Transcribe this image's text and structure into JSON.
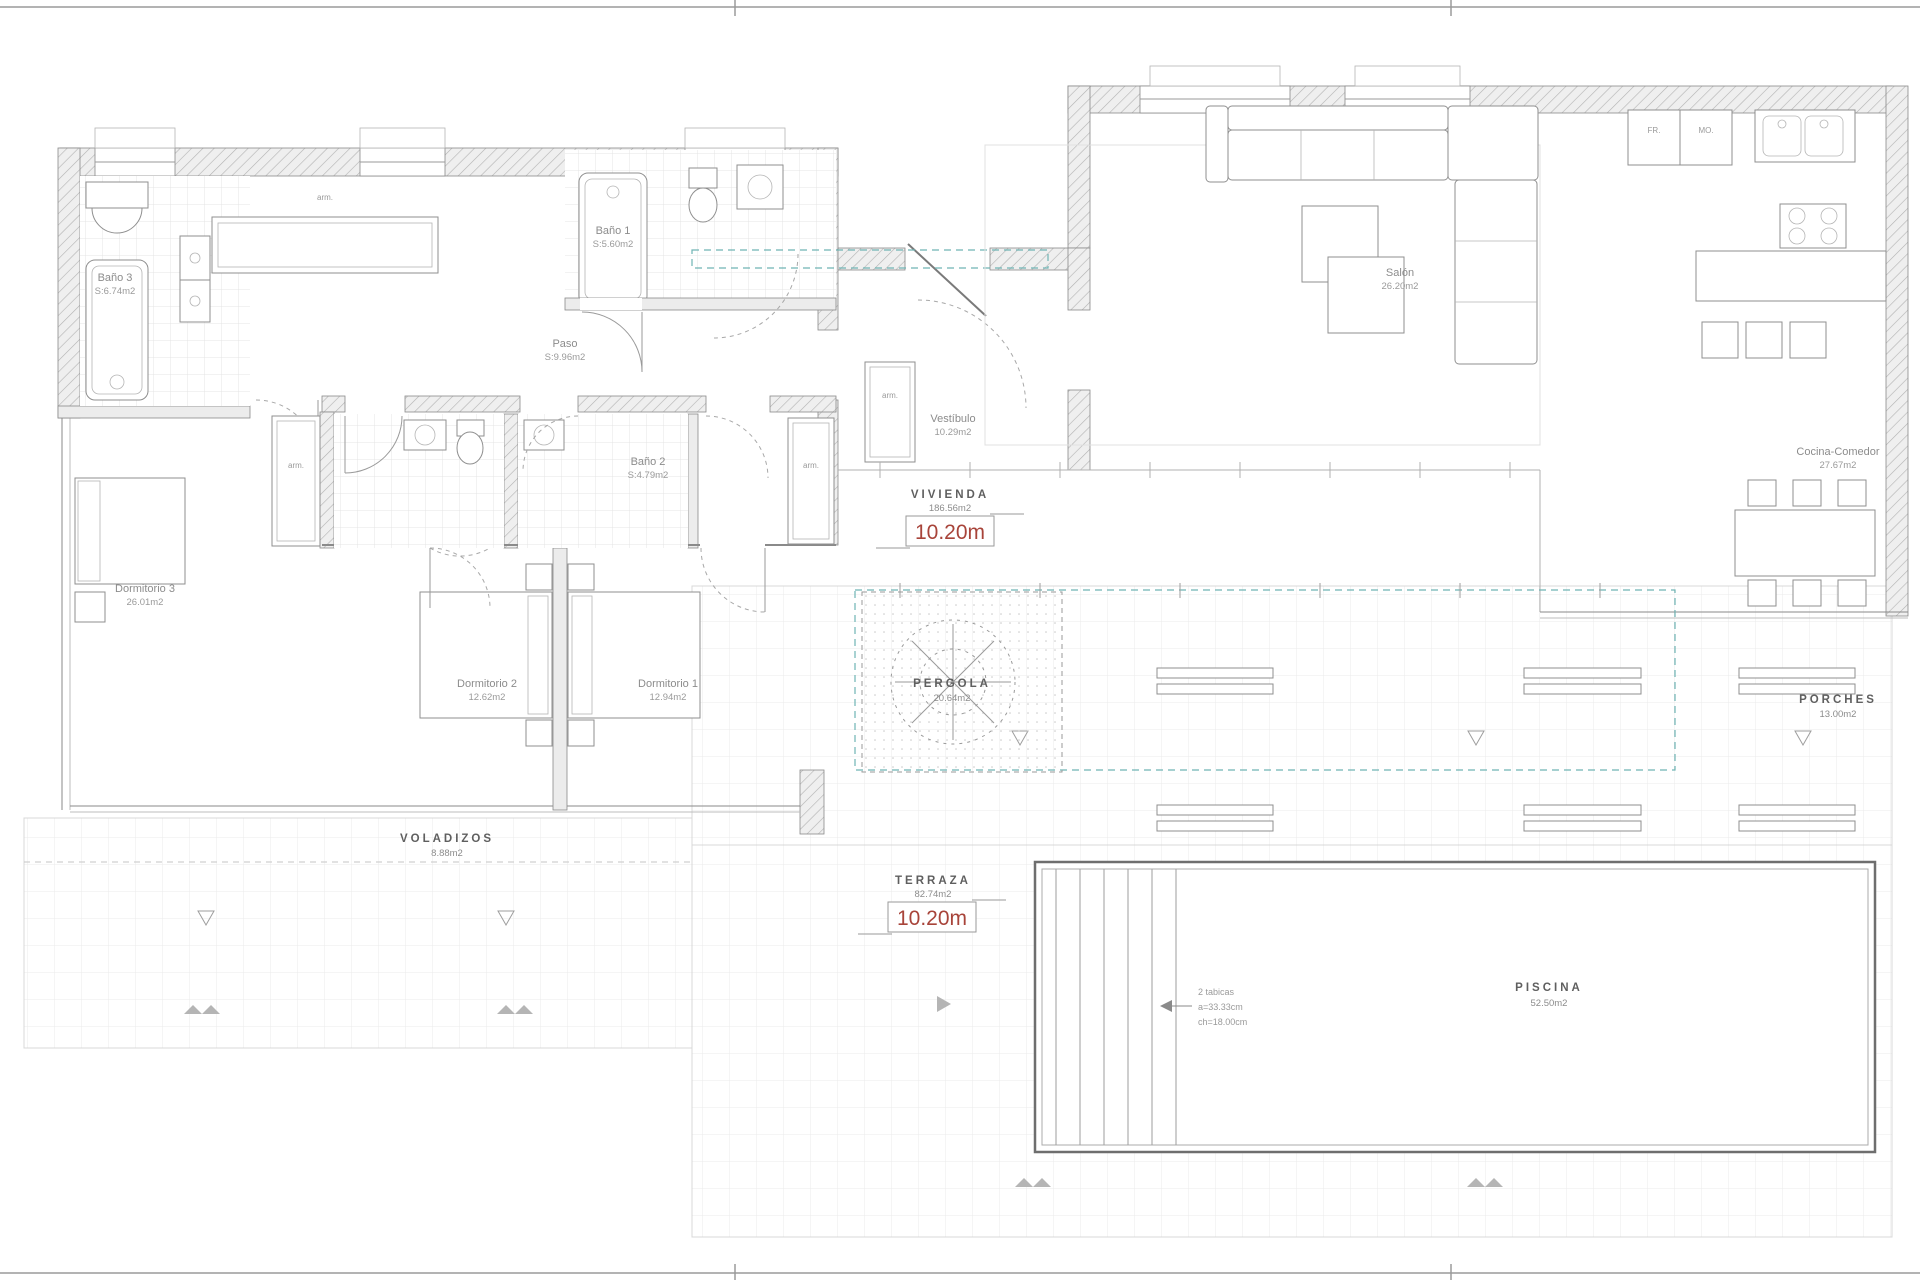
{
  "drawing_type": "architectural floor plan",
  "colors": {
    "accent_red": "#a8443a",
    "wall_gray": "#8a8a8a",
    "teal_dash": "#6fb3b3",
    "tile_gray": "#e0e0e0"
  },
  "labels": {
    "bano3": {
      "name": "Baño 3",
      "area": "S:6.74m2"
    },
    "bano1": {
      "name": "Baño 1",
      "area": "S:5.60m2"
    },
    "bano2": {
      "name": "Baño 2",
      "area": "S:4.79m2"
    },
    "paso": {
      "name": "Paso",
      "area": "S:9.96m2"
    },
    "dorm1": {
      "name": "Dormitorio 1",
      "area": "12.94m2"
    },
    "dorm2": {
      "name": "Dormitorio 2",
      "area": "12.62m2"
    },
    "dorm3": {
      "name": "Dormitorio 3",
      "area": "26.01m2"
    },
    "vestibulo": {
      "name": "Vestíbulo",
      "area": "10.29m2"
    },
    "salon": {
      "name": "Salón",
      "area": "26.20m2"
    },
    "cocina": {
      "name": "Cocina-Comedor",
      "area": "27.67m2"
    },
    "vivienda": {
      "name": "VIVIENDA",
      "area": "186.56m2",
      "dim": "10.20m"
    },
    "terraza": {
      "name": "TERRAZA",
      "area": "82.74m2",
      "dim": "10.20m"
    },
    "pergola": {
      "name": "PERGOLA",
      "area": "20.64m2"
    },
    "porches": {
      "name": "PORCHES",
      "area": "13.00m2"
    },
    "voladizos": {
      "name": "VOLADIZOS",
      "area": "8.88m2"
    },
    "piscina": {
      "name": "PISCINA",
      "area": "52.50m2"
    },
    "armario": "arm.",
    "pool_note": {
      "l1": "2 tabicas",
      "l2": "a=33.33cm",
      "l3": "ch=18.00cm"
    },
    "appliances": {
      "fr": "FR.",
      "mo": "MO."
    }
  }
}
